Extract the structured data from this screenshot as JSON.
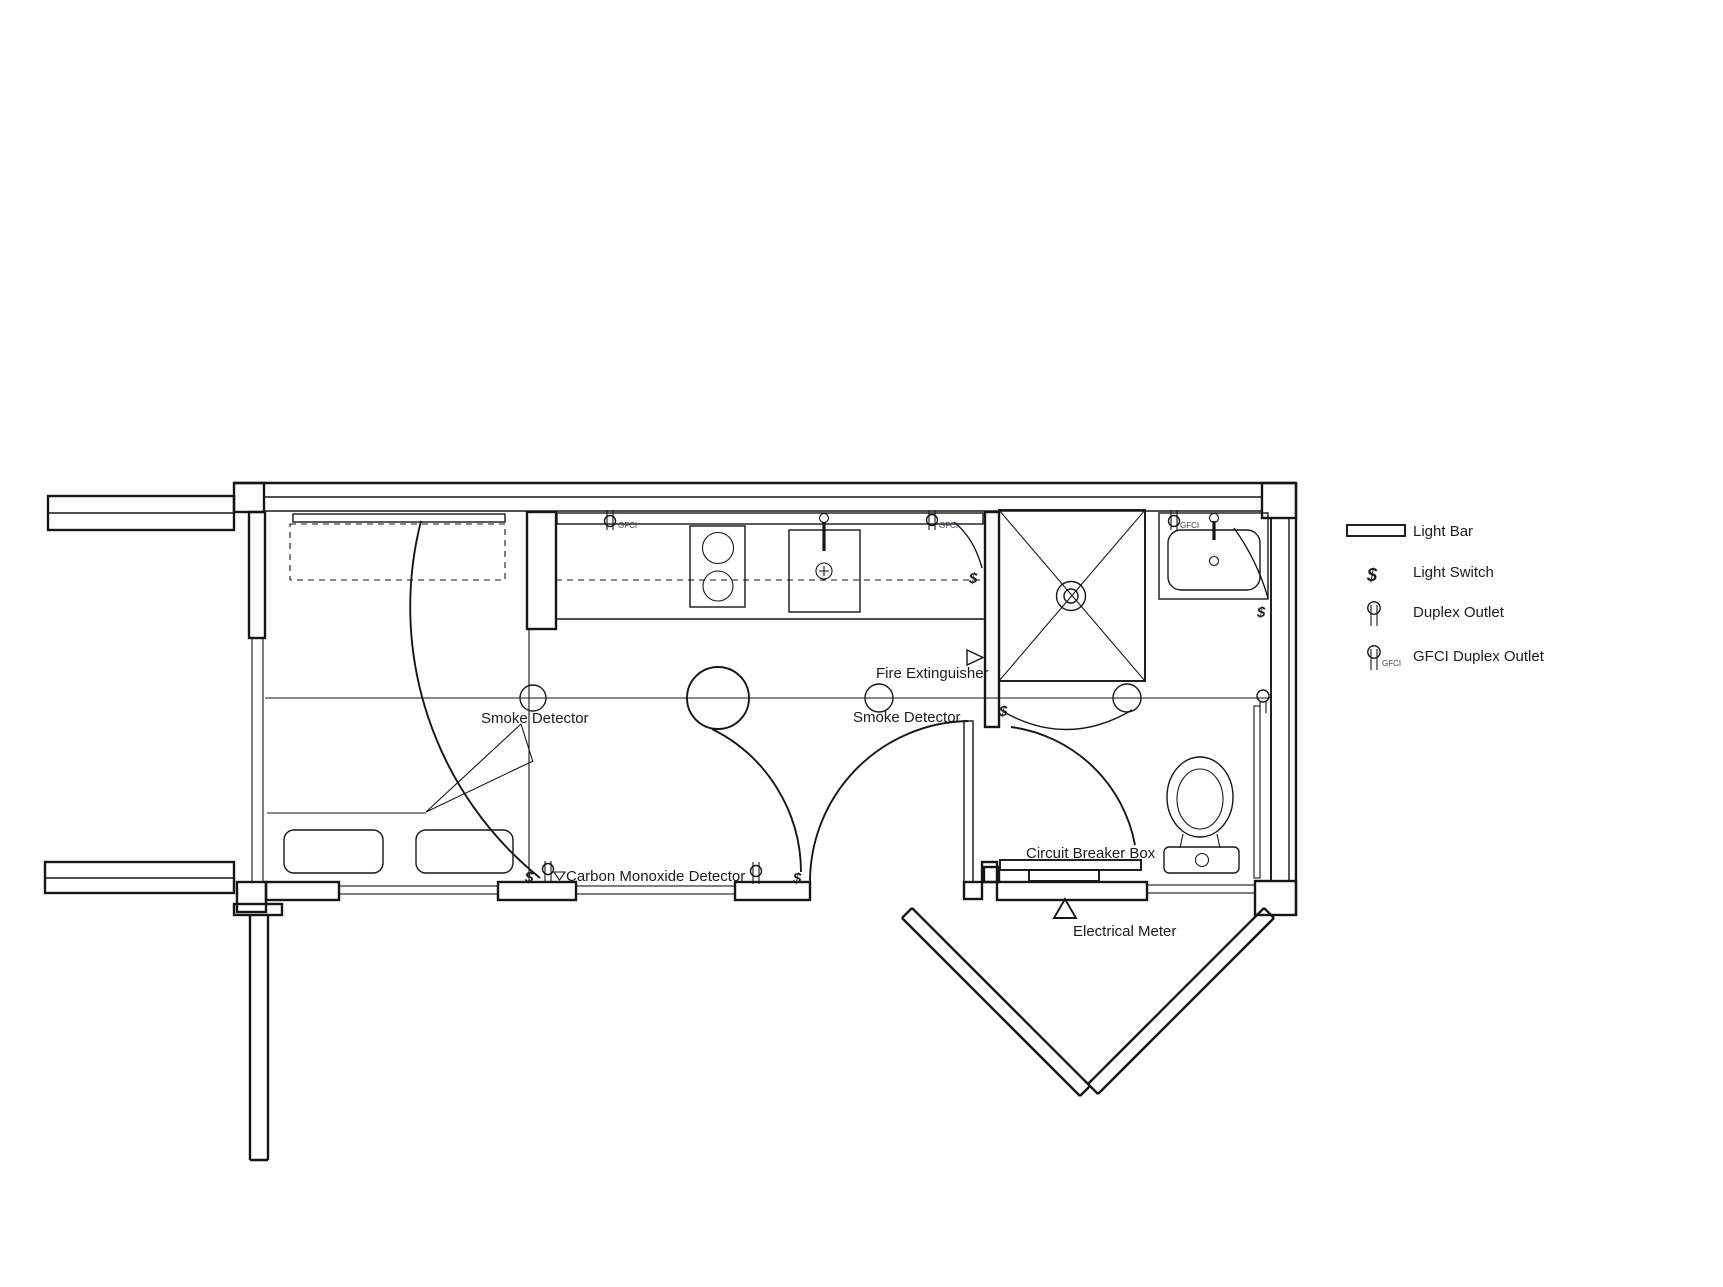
{
  "colors": {
    "ink": "#161616",
    "background": "#ffffff"
  },
  "plan": {
    "labels": {
      "smoke_detector": "Smoke Detector",
      "fire_extinguisher": "Fire Extinguisher",
      "carbon_monoxide_detector": "Carbon Monoxide Detector",
      "circuit_breaker_box": "Circuit Breaker Box",
      "electrical_meter": "Electrical Meter",
      "gfci_tag": "GFCI",
      "switch_glyph": "$"
    }
  },
  "legend": {
    "items": [
      {
        "id": "light-bar",
        "label": "Light Bar"
      },
      {
        "id": "light-switch",
        "label": "Light Switch",
        "glyph": "$"
      },
      {
        "id": "duplex-outlet",
        "label": "Duplex Outlet"
      },
      {
        "id": "gfci-duplex-outlet",
        "label": "GFCI Duplex Outlet",
        "tag": "GFCI"
      }
    ]
  }
}
